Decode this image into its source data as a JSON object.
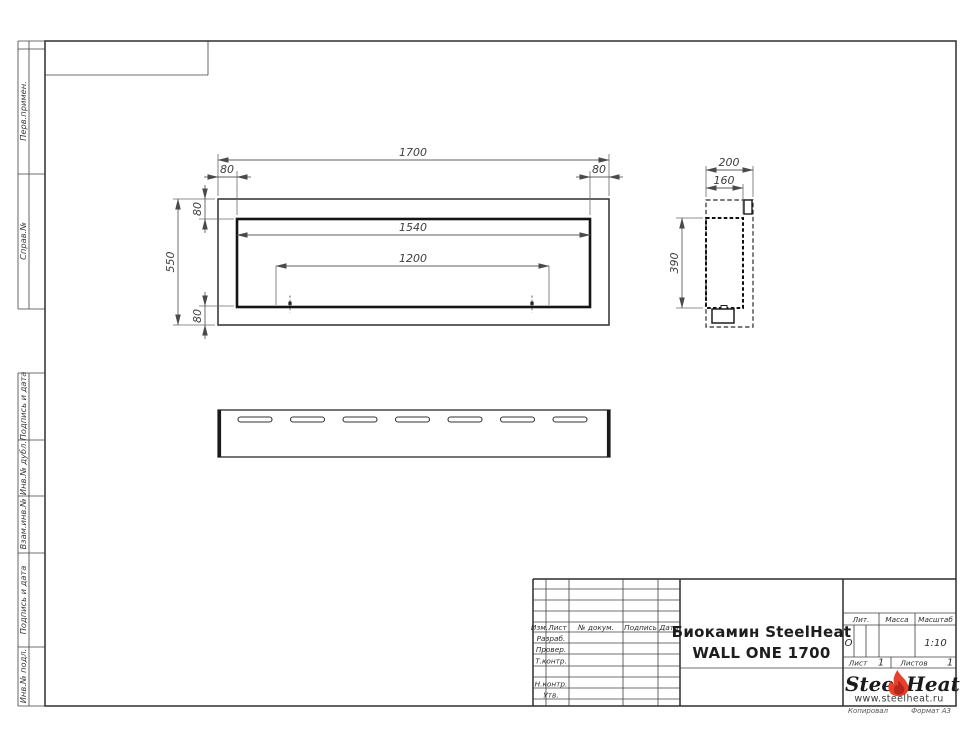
{
  "margin_stamps": {
    "items": [
      {
        "label": "Перв.примен."
      },
      {
        "label": "Справ.№"
      },
      {
        "label": "Подпись и дата"
      },
      {
        "label": "Инв.№ дубл."
      },
      {
        "label": "Взам.инв.№"
      },
      {
        "label": "Подпись и дата"
      },
      {
        "label": "Инв.№ подл."
      }
    ]
  },
  "drawing": {
    "front_view": {
      "overall_width": "1700",
      "overall_height": "550",
      "edge_left": "80",
      "edge_right": "80",
      "edge_top": "80",
      "edge_bottom": "80",
      "opening_width": "1540",
      "slot_spacing": "1200"
    },
    "side_view": {
      "depth": "200",
      "inner_depth": "160",
      "opening_height": "390"
    }
  },
  "title_block": {
    "revision_header": {
      "col_izm": "Изм.",
      "col_list": "Лист",
      "col_doc": "№ докум.",
      "col_sign": "Подпись",
      "col_date": "Дата"
    },
    "roles": {
      "developed": "Разраб.",
      "checked": "Провер.",
      "tcontrol": "Т.контр.",
      "ncontrol": "Н.контр.",
      "approved": "Утв."
    },
    "doc_title_line1": "Биокамин SteelHeat",
    "doc_title_line2": "WALL ONE 1700",
    "lit_label": "Лит.",
    "lit_value": "О",
    "mass_label": "Масса",
    "scale_label": "Масштаб",
    "scale_value": "1:10",
    "sheet_label": "Лист",
    "sheet_value": "1",
    "sheets_label": "Листов",
    "sheets_value": "1",
    "brand": {
      "name_part1": "Steel",
      "name_part2": "Heat",
      "website": "www.steelheat.ru",
      "flame_color": "#e8402d",
      "flame_core_color": "#b5271d"
    },
    "footer_copy": "Копировал",
    "footer_format": "Формат А3"
  }
}
